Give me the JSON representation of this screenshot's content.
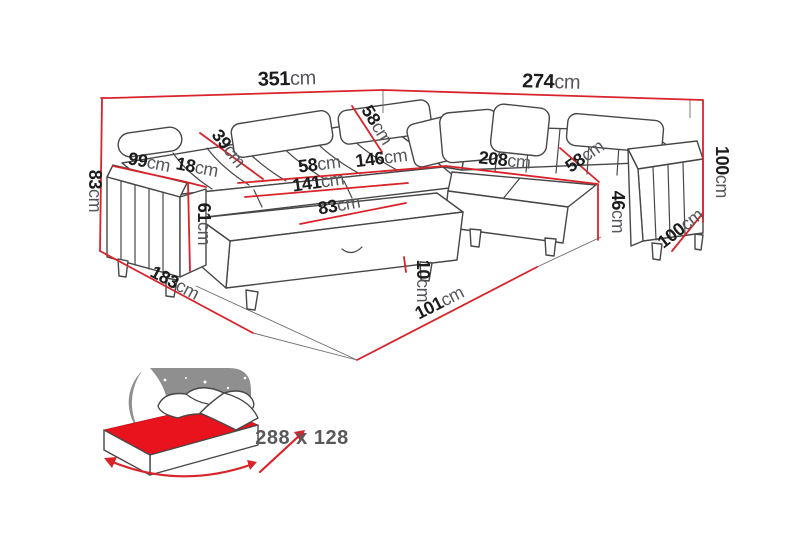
{
  "dimensions": {
    "top_width_left": {
      "value": "351",
      "unit": "cm"
    },
    "top_width_right": {
      "value": "274",
      "unit": "cm"
    },
    "left_height": {
      "value": "83",
      "unit": "cm"
    },
    "left_arm_depth": {
      "value": "99",
      "unit": "cm"
    },
    "left_arm_width": {
      "value": "18",
      "unit": "cm"
    },
    "backrest_diagonal": {
      "value": "39",
      "unit": "cm"
    },
    "corner_backrest_diagonal": {
      "value": "58",
      "unit": "cm"
    },
    "left_seat_depth": {
      "value": "58",
      "unit": "cm"
    },
    "corner_seat_width": {
      "value": "146",
      "unit": "cm"
    },
    "chaise_length": {
      "value": "141",
      "unit": "cm"
    },
    "chaise_width": {
      "value": "83",
      "unit": "cm"
    },
    "left_arm_front_height": {
      "value": "61",
      "unit": "cm"
    },
    "left_depth": {
      "value": "183",
      "unit": "cm"
    },
    "front_clearance": {
      "value": "10",
      "unit": "cm"
    },
    "front_width": {
      "value": "101",
      "unit": "cm"
    },
    "right_seat_width": {
      "value": "208",
      "unit": "cm"
    },
    "right_seat_depth": {
      "value": "58",
      "unit": "cm"
    },
    "seat_height": {
      "value": "46",
      "unit": "cm"
    },
    "right_height": {
      "value": "100",
      "unit": "cm"
    },
    "right_depth": {
      "value": "100",
      "unit": "cm"
    }
  },
  "sleeping_area": {
    "size_label": "288 x 128"
  },
  "colors": {
    "dimension_line": "#d8232a",
    "drawing_line": "#474747",
    "number_text": "#1c1c1c",
    "unit_text": "#56575b",
    "icon_panel_gray": "#8f8f8f",
    "mattress_red": "#e8131d",
    "size_text": "#58595b",
    "background": "#ffffff"
  }
}
